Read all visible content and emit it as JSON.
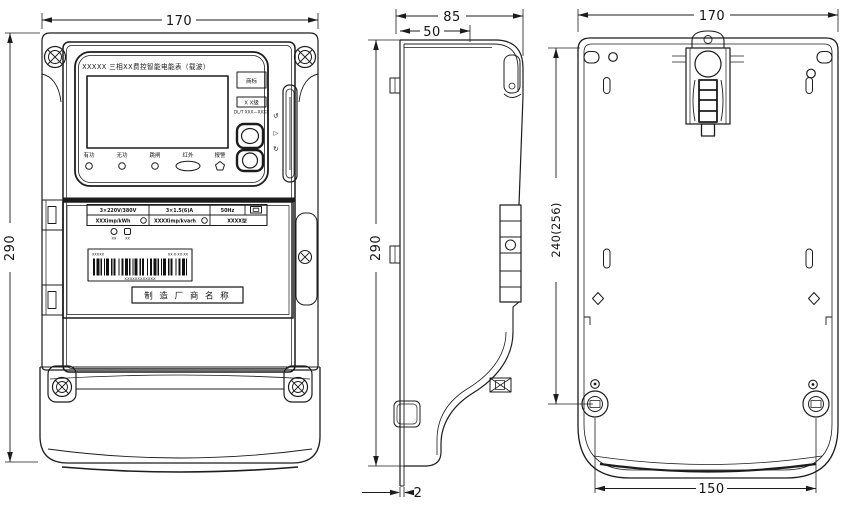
{
  "dimensions": {
    "front_width": "170",
    "front_height": "290",
    "side_total_depth": "85",
    "side_front_depth": "50",
    "side_height": "290",
    "back_plate_thickness": "2",
    "back_width": "170",
    "mount_hole_span": "240(256)",
    "bottom_screw_span": "150"
  },
  "front": {
    "title": "XXXXX 三相XX费控智能电能表（载波）",
    "trademark": "商标",
    "class_mark": "X X级",
    "standard": "DL/T XXX—XXXX",
    "buttons": [
      "有功",
      "无功",
      "跳闸",
      "红外",
      "报警"
    ],
    "comm_icons": [
      "↺",
      "▷",
      "↻"
    ],
    "nameplate": {
      "voltage": "3×220V/380V",
      "current": "3×1.5(6)A",
      "frequency": "50Hz",
      "active_constant": "XXXimp/kWh",
      "reactive_constant": "XXXXimp/kvarh",
      "model": "XXXX型",
      "led_left": "XX",
      "led_right": "XX",
      "barcode_left": "XXXXX",
      "barcode_right": "XX·X·XX·XX",
      "barcode_number": "XXXXXXXXXXXX",
      "manufacturer": "制 造 厂 商 名 称"
    }
  }
}
